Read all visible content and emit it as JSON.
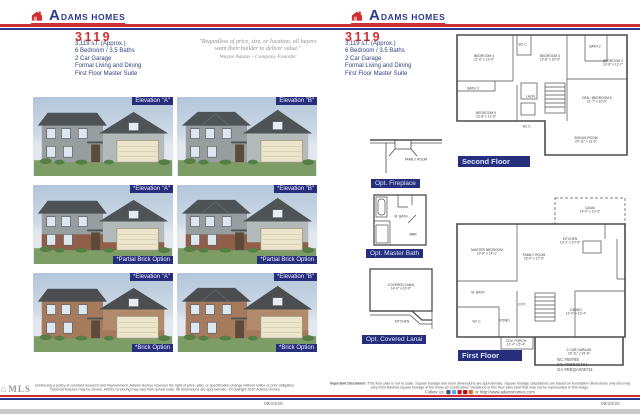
{
  "logo": {
    "initial": "A",
    "name_rest": "DAMS HOMES"
  },
  "plan": {
    "number": "3119",
    "specs": [
      "3,119 s.f. (Approx.)",
      "6 Bedroom / 3.5 Baths",
      "2 Car Garage",
      "Formal Living and Dining",
      "First Floor Master Suite"
    ]
  },
  "left_page": {
    "quote": {
      "text": "\"Regardless of price, size, or location, all buyers want their builder to deliver value.\"",
      "attribution": "Wayne Adams - Company Founder"
    },
    "elevations": [
      {
        "top_label": "Elevation \"A\""
      },
      {
        "top_label": "Elevation \"B\""
      },
      {
        "top_label": "*Elevation \"A\"",
        "bottom_label": "*Partial Brick Option"
      },
      {
        "top_label": "*Elevation \"B\"",
        "bottom_label": "*Partial Brick Option"
      },
      {
        "top_label": "*Elevation \"A\"",
        "bottom_label": "*Brick Option"
      },
      {
        "top_label": "*Elevation \"B\"",
        "bottom_label": "*Brick Option"
      }
    ],
    "footer": {
      "logo_text": "MLS",
      "disclaimer": "Continuing a policy of constant research and improvement, Adams Homes reserves the right of price, plan, or specification change without notice or prior obligation. Optional features may be shown. Artist's rendering may vary from actual scale. All dimensions are approximate. ©Copyright 2020 Adams Homes",
      "date": "09/10/20"
    }
  },
  "right_page": {
    "options": [
      {
        "label": "Opt. Fireplace",
        "rooms": [
          {
            "label": "FAMILY ROOM",
            "x": 62,
            "y": 62
          }
        ]
      },
      {
        "label": "Opt. Master Bath",
        "rooms": [
          {
            "label": "M. BATH",
            "x": 52,
            "y": 44
          },
          {
            "label": "MBR",
            "x": 74,
            "y": 78
          }
        ]
      },
      {
        "label": "Opt. Covered Lanai",
        "rooms": [
          {
            "label": "COVERED LANAI",
            "dims": "14'-0\" x 10'-0\"",
            "x": 50,
            "y": 32
          },
          {
            "label": "KITCHEN",
            "x": 52,
            "y": 86
          }
        ]
      }
    ],
    "second_floor": {
      "label": "Second Floor",
      "rooms": [
        {
          "label": "BEDROOM 4",
          "dims": "11'-0\" x 13'-0\"",
          "x": 16,
          "y": 20
        },
        {
          "label": "W.I.C.",
          "x": 38,
          "y": 10
        },
        {
          "label": "BEDROOM 3",
          "dims": "13'-8\" x 10'-0\"",
          "x": 53,
          "y": 20
        },
        {
          "label": "BATH 2",
          "x": 78,
          "y": 11
        },
        {
          "label": "BEDROOM 2",
          "dims": "13'-8\" x 11'-7\"",
          "x": 88,
          "y": 24
        },
        {
          "label": "BATH 3",
          "x": 10,
          "y": 45
        },
        {
          "label": "BEDROOM 5",
          "dims": "13'-8\" x 11'-8\"",
          "x": 17,
          "y": 66
        },
        {
          "label": "LAUN.",
          "x": 42,
          "y": 52
        },
        {
          "label": "W.I.C.",
          "x": 40,
          "y": 76
        },
        {
          "label": "DEN / BEDROOM 6",
          "dims": "11'-7\" x 10'-0\"",
          "x": 79,
          "y": 54
        },
        {
          "label": "BONUS ROOM",
          "dims": "20'-11\" x 13'-0\"",
          "x": 73,
          "y": 86
        }
      ]
    },
    "first_floor": {
      "label": "First Floor",
      "rooms": [
        {
          "label": "LANAI",
          "dims": "14'-0\" x 10'-0\"",
          "x": 75,
          "y": 9
        },
        {
          "label": "MASTER BEDROOM",
          "dims": "13'-8\" x 14'-1\"",
          "x": 18,
          "y": 33
        },
        {
          "label": "FAMILY ROOM",
          "dims": "16'-4\" x 17'-0\"",
          "x": 44,
          "y": 36
        },
        {
          "label": "KITCHEN",
          "dims": "13'-2\" x 10'-9\"",
          "x": 64,
          "y": 27
        },
        {
          "label": "M. BATH",
          "x": 13,
          "y": 57
        },
        {
          "label": "FOY.",
          "x": 37,
          "y": 64
        },
        {
          "label": "POWD.",
          "x": 28,
          "y": 73
        },
        {
          "label": "W.I.C.",
          "x": 12,
          "y": 74
        },
        {
          "label": "DINING",
          "dims": "12'-0\" x 12'-4\"",
          "x": 67,
          "y": 68
        },
        {
          "label": "COV. PORCH",
          "dims": "11'-4\" x 5'-4\"",
          "x": 34,
          "y": 86
        },
        {
          "label": "2 CAR GARAGE",
          "dims": "20'-11\" x 19'-8\"",
          "x": 69,
          "y": 91
        }
      ]
    },
    "licenses": [
      "NC #59785",
      "SC #RBB22464",
      "GA #RBQA005711"
    ],
    "footer": {
      "disclaimer_lead": "Important Disclaimer:",
      "disclaimer_body": " This floor plan is not to scale. Square footage and room dimensions are approximate. Square footage calculations are based on foundation dimensions only and may vary from finished square footage of the home as constructed. Variations of this floor plan exist that may not be represented in this image.",
      "follow_label": "Follow Us:",
      "follow_suffix": "or http://www.adamshomes.com",
      "date": "09/10/20",
      "social": [
        {
          "name": "facebook",
          "color": "#3b5998"
        },
        {
          "name": "twitter",
          "color": "#55acee"
        },
        {
          "name": "youtube",
          "color": "#cc181e"
        },
        {
          "name": "pinterest",
          "color": "#bd081c"
        },
        {
          "name": "instagram",
          "color": "#e06a2c"
        }
      ]
    }
  },
  "colors": {
    "brand_red": "#cf2e31",
    "brand_blue": "#2b3a8f",
    "label_bg": "#272f7d"
  }
}
